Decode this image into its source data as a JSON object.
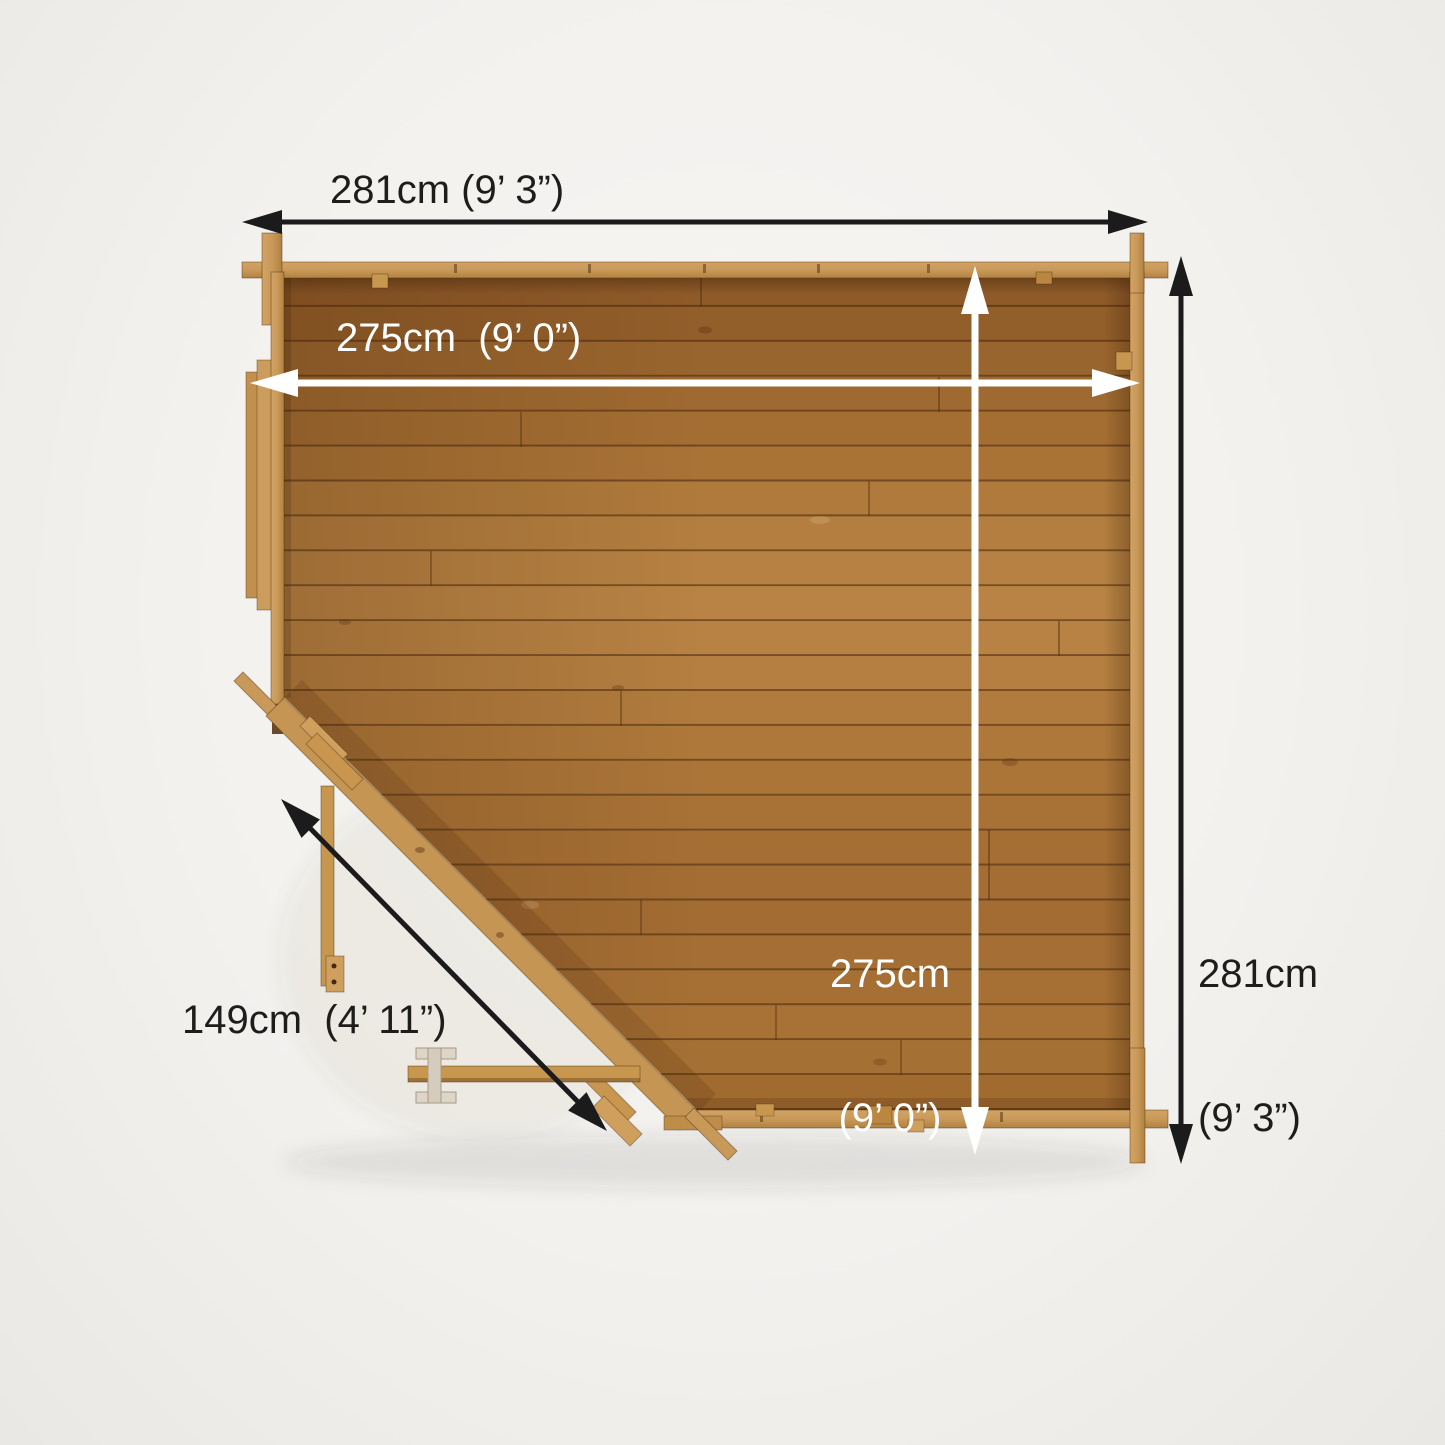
{
  "labels": {
    "outer_width": "281cm (9’ 3”)",
    "inner_width": "275cm  (9’ 0”)",
    "inner_depth": {
      "line1": "275cm",
      "line2": "(9’ 0”)"
    },
    "outer_depth": {
      "line1": "281cm",
      "line2": "(9’ 3”)"
    },
    "door_width": "149cm  (4’ 11”)"
  },
  "colors": {
    "background": "#f2f0ed",
    "text_dark": "#1d1d1b",
    "text_light": "#ffffff",
    "dimension_black": "#1b1b1b",
    "dimension_white": "#ffffff",
    "wall_wood": "#c9995a",
    "wall_wood_dark": "#bf8d4a",
    "wall_wood_light": "#cf9f5e",
    "floor_wood_mid": "#ad773a",
    "plank_palette": [
      "#8e5a28",
      "#925e2a",
      "#99652e",
      "#9f6a31",
      "#a46e33",
      "#a97336",
      "#af7a3b",
      "#b37e3f",
      "#b68142",
      "#b88344",
      "#b78243",
      "#b47f40",
      "#b17b3d",
      "#ae783a",
      "#ab7538",
      "#a87236",
      "#a56f34",
      "#a36d33",
      "#a26c32",
      "#a46e34",
      "#a67034",
      "#a87236",
      "#a57033",
      "#a16b30"
    ]
  }
}
